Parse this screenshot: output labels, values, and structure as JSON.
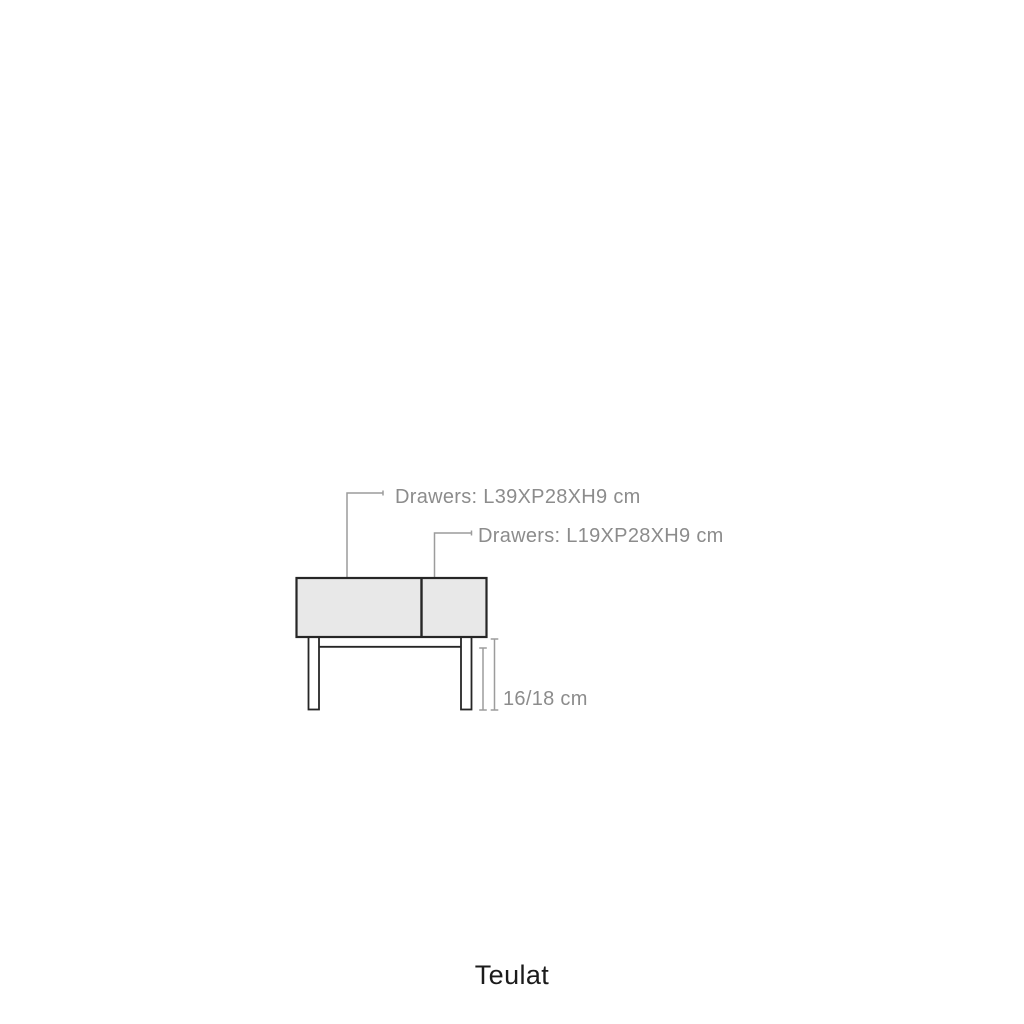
{
  "page": {
    "background_color": "#ffffff",
    "description": "Product dimension diagram of a two-drawer sideboard, front view"
  },
  "diagram": {
    "labels": {
      "drawer_large": "Drawers: L39XP28XH9 cm",
      "drawer_small": "Drawers: L19XP28XH9 cm",
      "base_height": "16/18 cm"
    },
    "colors": {
      "outline": "#262626",
      "panel_fill": "#e8e8e8",
      "annotation_text": "#8c8c8c",
      "leader_line": "#9c9c9c"
    }
  },
  "brand": {
    "name": "Teulat",
    "color": "#1b1b1b"
  }
}
